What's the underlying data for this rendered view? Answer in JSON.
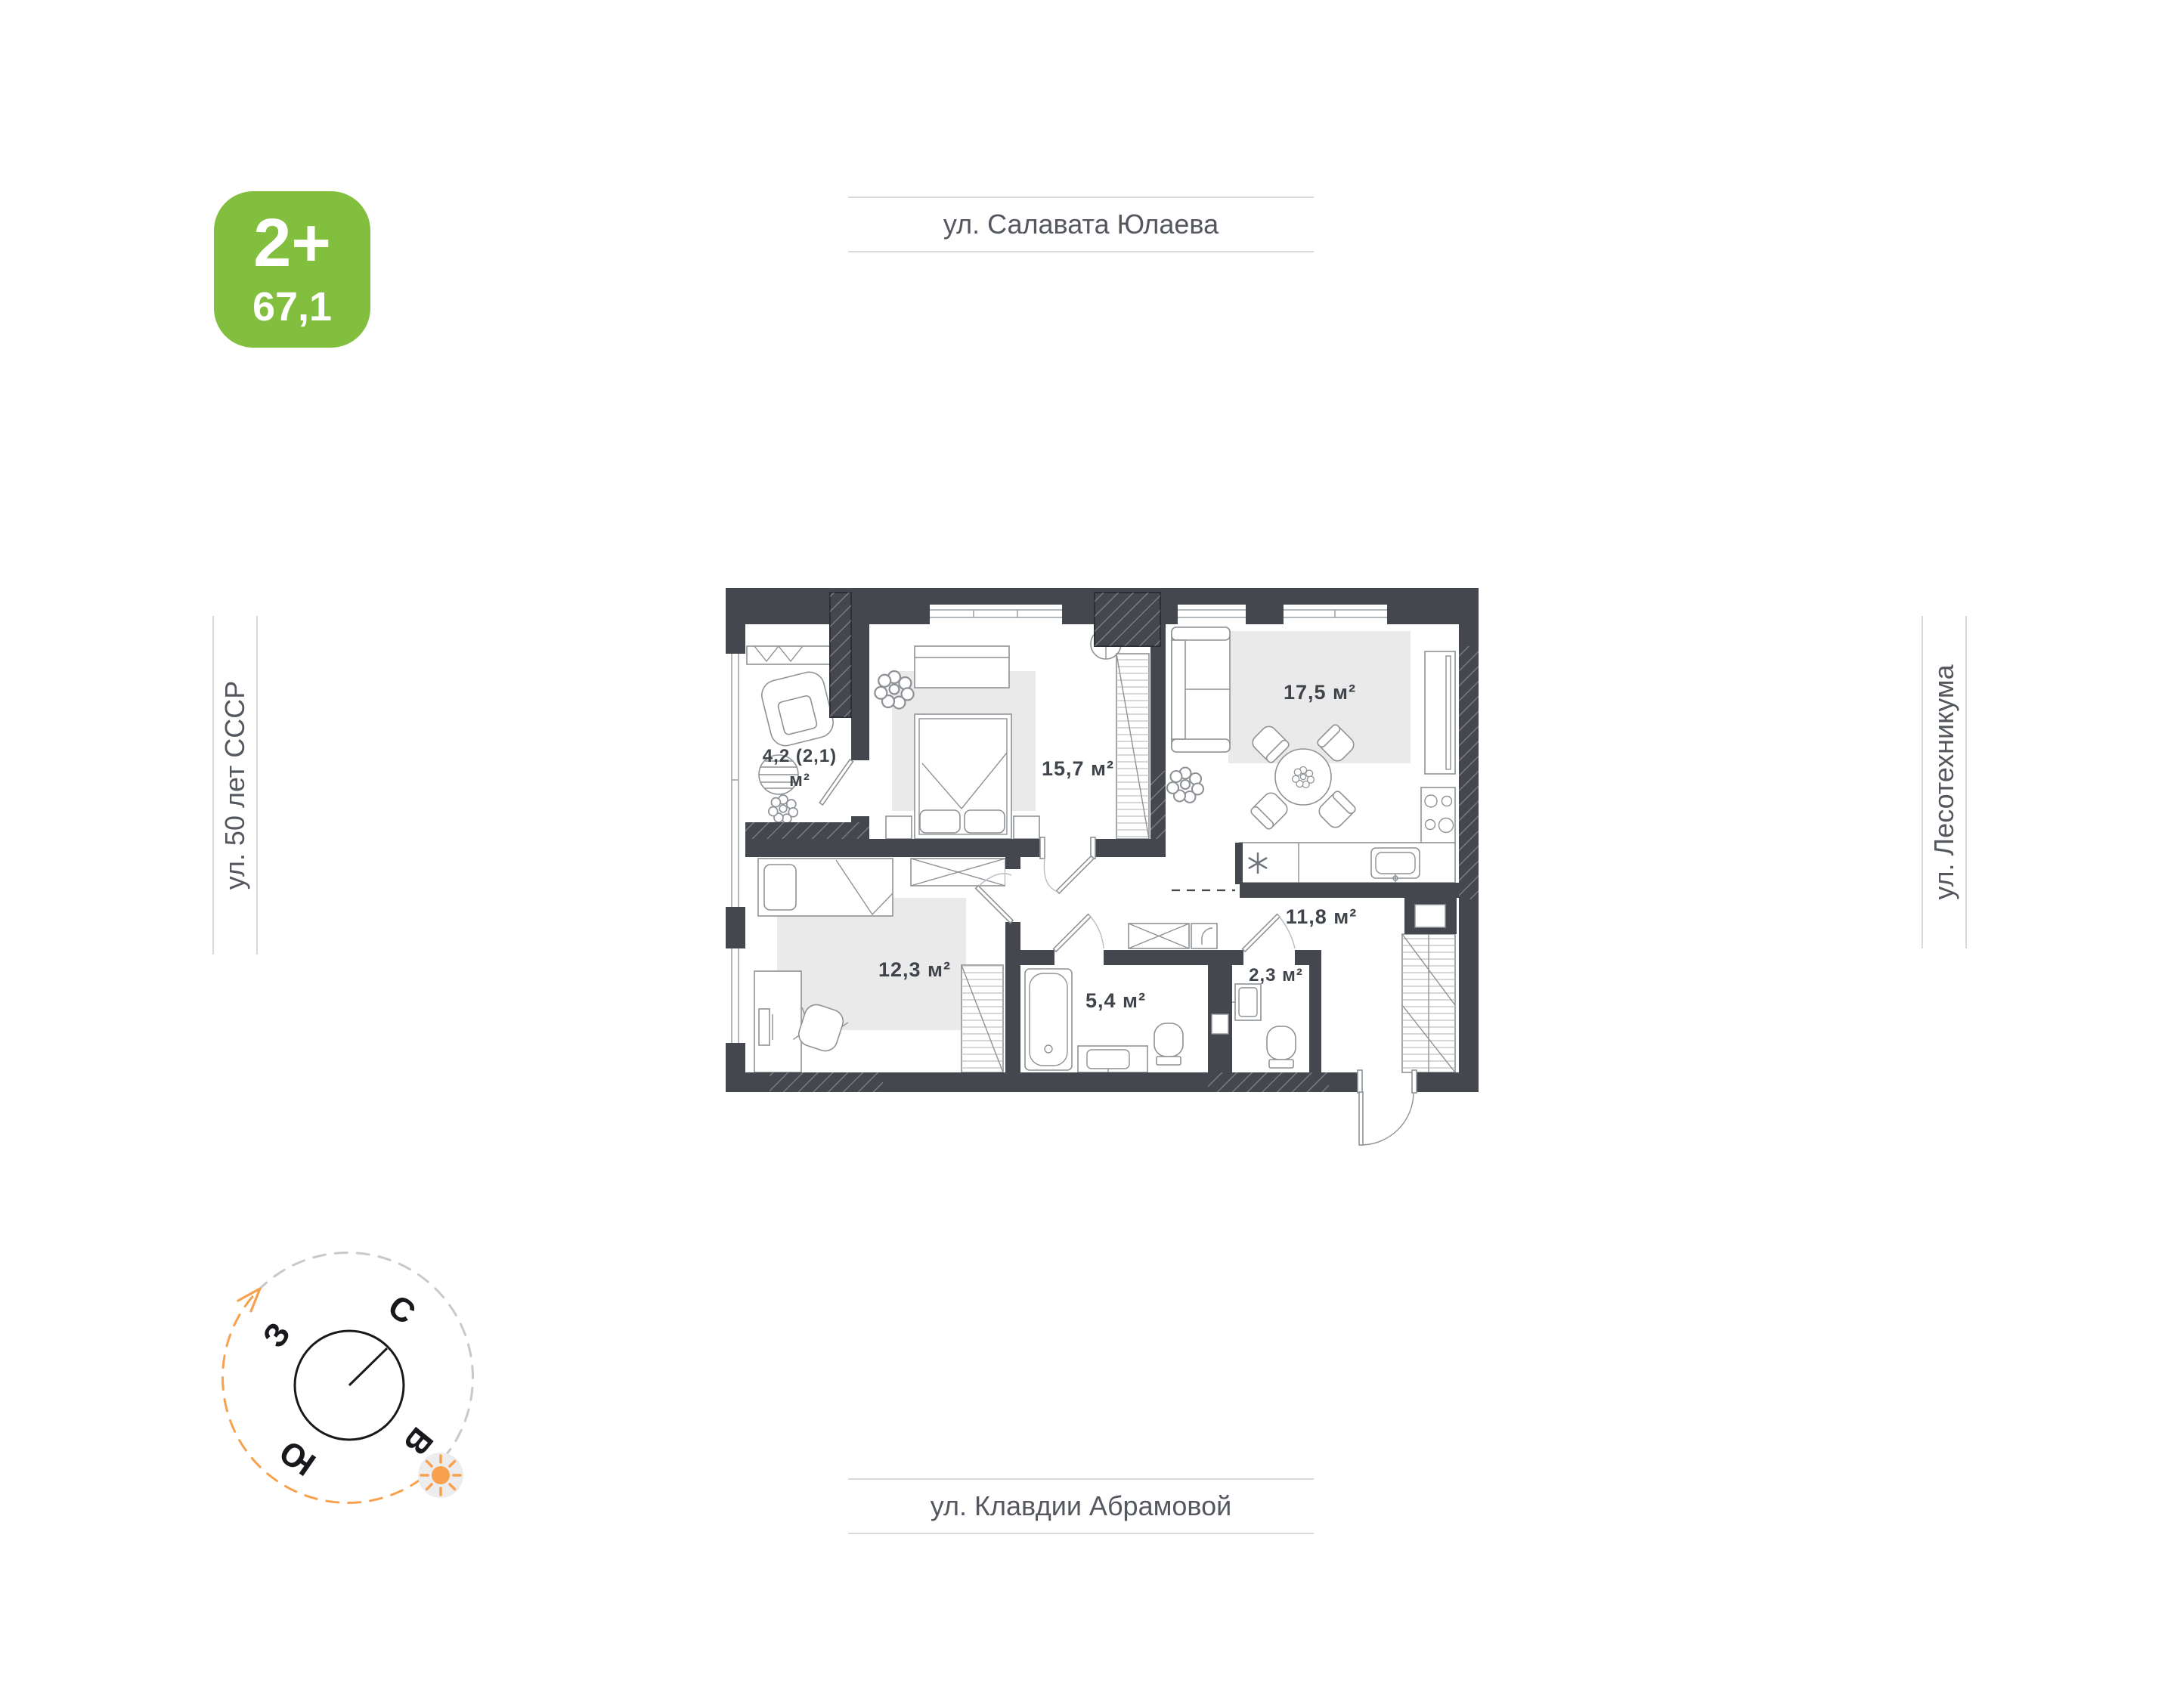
{
  "badge": {
    "label": "2+",
    "area": "67,1"
  },
  "streets": {
    "top": "ул. Салавата Юлаева",
    "left": "ул. 50 лет СССР",
    "right": "ул. Лесотехникума",
    "bottom": "ул. Клавдии Абрамовой"
  },
  "compass": {
    "north": "С",
    "west": "З",
    "south": "Ю",
    "east": "В"
  },
  "plan": {
    "rooms": {
      "loggia": {
        "area": "4,2 (2,1)",
        "unit": "м²"
      },
      "bedroom_main": {
        "label": "15,7 м²"
      },
      "kitchen_living": {
        "label": "17,5 м²"
      },
      "bedroom_second": {
        "label": "12,3 м²"
      },
      "hallway": {
        "label": "11,8 м²"
      },
      "bathroom": {
        "label": "5,4 м²"
      },
      "wc": {
        "label": "2,3 м²"
      }
    }
  },
  "colors": {
    "badge_green": "#82bf3e",
    "wall_dark": "#44474d",
    "accent_orange": "#f7a14e",
    "rug_gray": "#eaeaea",
    "street_line": "#dadada",
    "street_text": "#54585e",
    "label_text": "#3f444b"
  }
}
